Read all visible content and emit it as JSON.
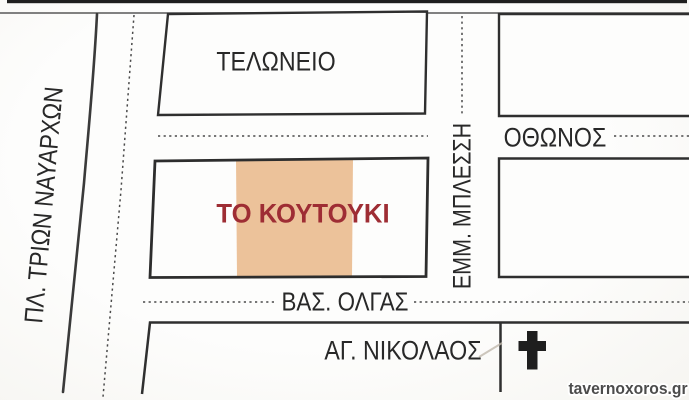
{
  "map": {
    "region_labels": {
      "plaza": "ΠΛ. ΤΡΙΩΝ ΝΑΥΑΡΧΩΝ",
      "customs_block": "ΤΕΛΩΝΕΙΟ",
      "venue": "ΤΟ ΚΟΥΤΟΥΚΙ",
      "church_block": "ΑΓ. ΝΙΚΟΛΑΟΣ"
    },
    "street_labels": {
      "othonos": "ΟΘΩΝΟΣ",
      "emm_blessi": "ΕΜΜ. ΜΠΛΕΣΣΗ",
      "vas_olgas": "ΒΑΣ. ΟΛΓΑΣ"
    },
    "icons": {
      "church_cross": "✝"
    },
    "colors": {
      "venue_text": "#9e2d34",
      "venue_highlight": "#ecc29a",
      "line": "#333333",
      "label": "#282828"
    },
    "watermark": "tavernoxoros.gr"
  }
}
